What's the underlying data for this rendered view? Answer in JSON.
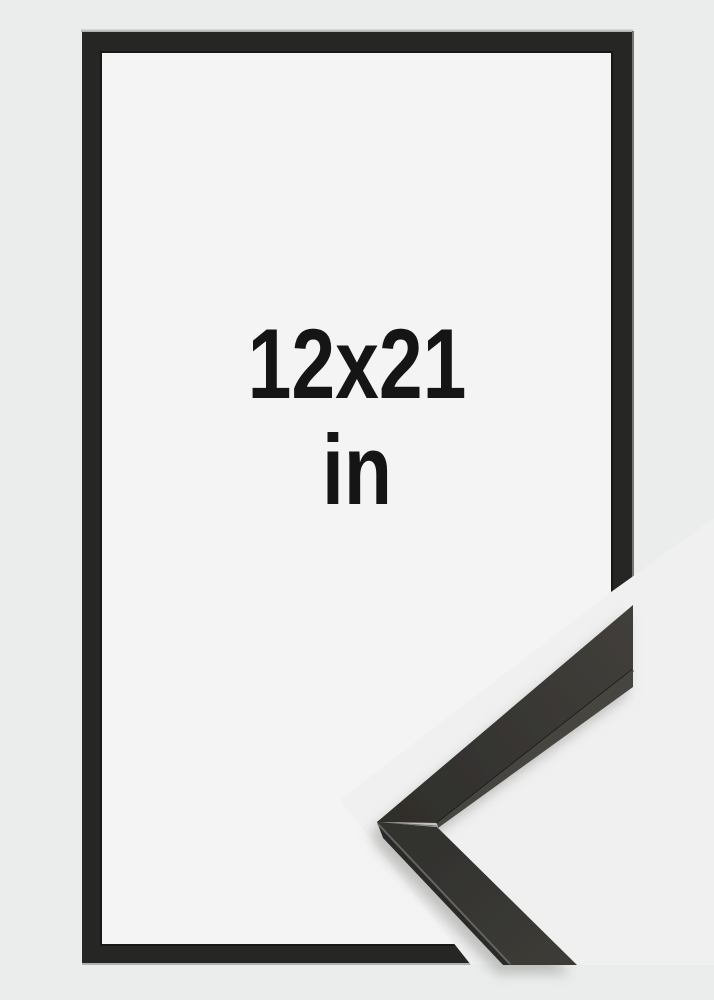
{
  "size_label": {
    "dimensions": "12x21",
    "unit": "in"
  },
  "colors": {
    "page_bg": "#ebedec",
    "opening_bg": "#f3f4f3",
    "photo_bg": "#eff0ef",
    "frame_color": "#262624",
    "frame_inner_line": "#171715",
    "text_color": "#151515",
    "moulding_dark": "#2f2e2b",
    "moulding_light": "#413f3b",
    "moulding_lower_dark": "#31302d",
    "moulding_lower_light": "#3c3b37",
    "moulding_side": "#2c2b29",
    "moulding_facet": "#46443f",
    "edge_line": "#161513",
    "highlight_line": "#6b6a63",
    "shadow": "#9fa09e"
  }
}
